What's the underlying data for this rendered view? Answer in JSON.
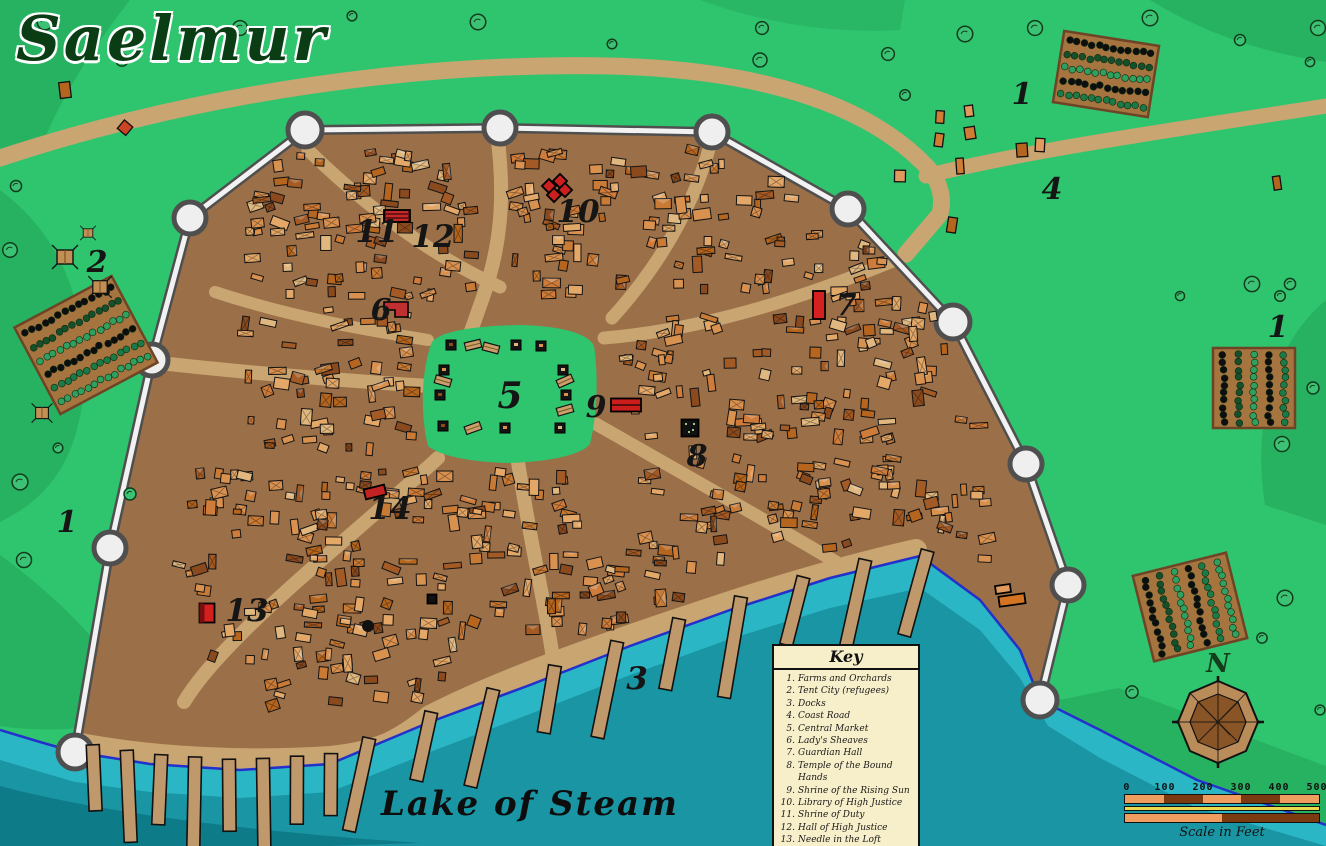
{
  "title": "Saelmur",
  "lake_label": "Lake of Steam",
  "compass": {
    "north_label": "N"
  },
  "scale_bar": {
    "ticks": [
      "0",
      "100",
      "200",
      "300",
      "400",
      "500"
    ],
    "caption": "Scale in Feet"
  },
  "key": {
    "title": "Key",
    "items": [
      {
        "num": "1.",
        "label": "Farms and Orchards"
      },
      {
        "num": "2.",
        "label": "Tent City (refugees)"
      },
      {
        "num": "3.",
        "label": "Docks"
      },
      {
        "num": "4.",
        "label": "Coast Road"
      },
      {
        "num": "5.",
        "label": "Central Market"
      },
      {
        "num": "6.",
        "label": "Lady's Sheaves"
      },
      {
        "num": "7.",
        "label": "Guardian Hall"
      },
      {
        "num": "8.",
        "label": "Temple of the Bound Hands"
      },
      {
        "num": "9.",
        "label": "Shrine of the Rising Sun"
      },
      {
        "num": "10.",
        "label": "Library of High Justice"
      },
      {
        "num": "11.",
        "label": "Shrine of Duty"
      },
      {
        "num": "12.",
        "label": "Hall of High Justice"
      },
      {
        "num": "13.",
        "label": "Needle in the Loft"
      },
      {
        "num": "14.",
        "label": "The Knaves Nape"
      }
    ]
  },
  "map_markers": [
    {
      "label": "1",
      "x": 1022,
      "y": 96,
      "size": 30
    },
    {
      "label": "4",
      "x": 1052,
      "y": 191,
      "size": 30
    },
    {
      "label": "2",
      "x": 97,
      "y": 264,
      "size": 30
    },
    {
      "label": "1",
      "x": 1278,
      "y": 329,
      "size": 30
    },
    {
      "label": "1",
      "x": 67,
      "y": 524,
      "size": 30
    },
    {
      "label": "3",
      "x": 637,
      "y": 681,
      "size": 31
    },
    {
      "label": "5",
      "x": 510,
      "y": 398,
      "size": 36
    },
    {
      "label": "6",
      "x": 381,
      "y": 312,
      "size": 30
    },
    {
      "label": "7",
      "x": 846,
      "y": 307,
      "size": 30
    },
    {
      "label": "8",
      "x": 697,
      "y": 458,
      "size": 30
    },
    {
      "label": "9",
      "x": 596,
      "y": 409,
      "size": 30
    },
    {
      "label": "10",
      "x": 578,
      "y": 214,
      "size": 31
    },
    {
      "label": "11",
      "x": 377,
      "y": 234,
      "size": 31
    },
    {
      "label": "12",
      "x": 433,
      "y": 239,
      "size": 31
    },
    {
      "label": "13",
      "x": 247,
      "y": 613,
      "size": 31
    },
    {
      "label": "14",
      "x": 390,
      "y": 511,
      "size": 31
    }
  ],
  "colors": {
    "grass": "#2fc46e",
    "grass_dark": "#27b261",
    "water_light": "#2ab6c5",
    "water_mid": "#1995a4",
    "water_dark": "#0e7b88",
    "shore_line": "#2430cc",
    "city_ground": "#9b6f47",
    "road": "#c8a571",
    "wall_white": "#f2f2f2",
    "wall_gray": "#4f4f4f",
    "pier": "#bf986b",
    "farm": "#a5743f",
    "key_bg": "#f7eeca",
    "accent_red": "#cc2020",
    "title_green": "#0b3d15"
  }
}
